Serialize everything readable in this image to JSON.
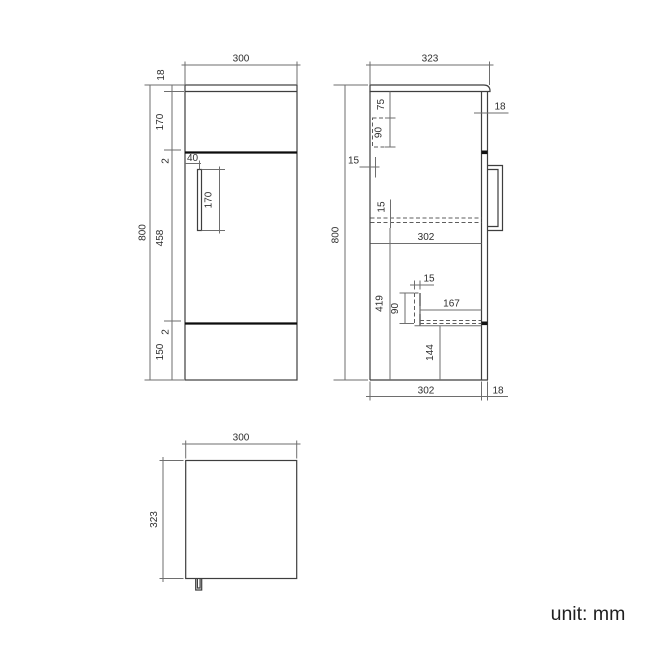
{
  "footer": {
    "unit_label": "unit: mm"
  },
  "colors": {
    "outline": "#3e3e3e",
    "dimension_line": "#6e6e6e",
    "hidden_line": "#5d5d5d",
    "divider": "#0c0c0c",
    "text": "#2e2e2e"
  },
  "front_view": {
    "overall_width": "300",
    "overall_height": "800",
    "top_panel_thickness": "18",
    "upper_front_height": "170",
    "upper_gap": "2",
    "door_height": "458",
    "lower_gap": "2",
    "plinth_height": "150",
    "handle_inset": "40",
    "handle_length": "170"
  },
  "side_view": {
    "overall_depth": "323",
    "overall_height": "800",
    "door_thickness": "18",
    "top_offset": "75",
    "hidden_box_height": "90",
    "back_inset": "15",
    "shelf_thickness": "15",
    "internal_depth": "302",
    "lower_internal_height": "419",
    "support_thickness": "15",
    "support_height": "90",
    "shelf_depth": "167",
    "recess_height": "144",
    "bottom_internal_depth": "302",
    "bottom_door_thickness": "18"
  },
  "plan_view": {
    "overall_width": "300",
    "overall_depth": "323"
  }
}
